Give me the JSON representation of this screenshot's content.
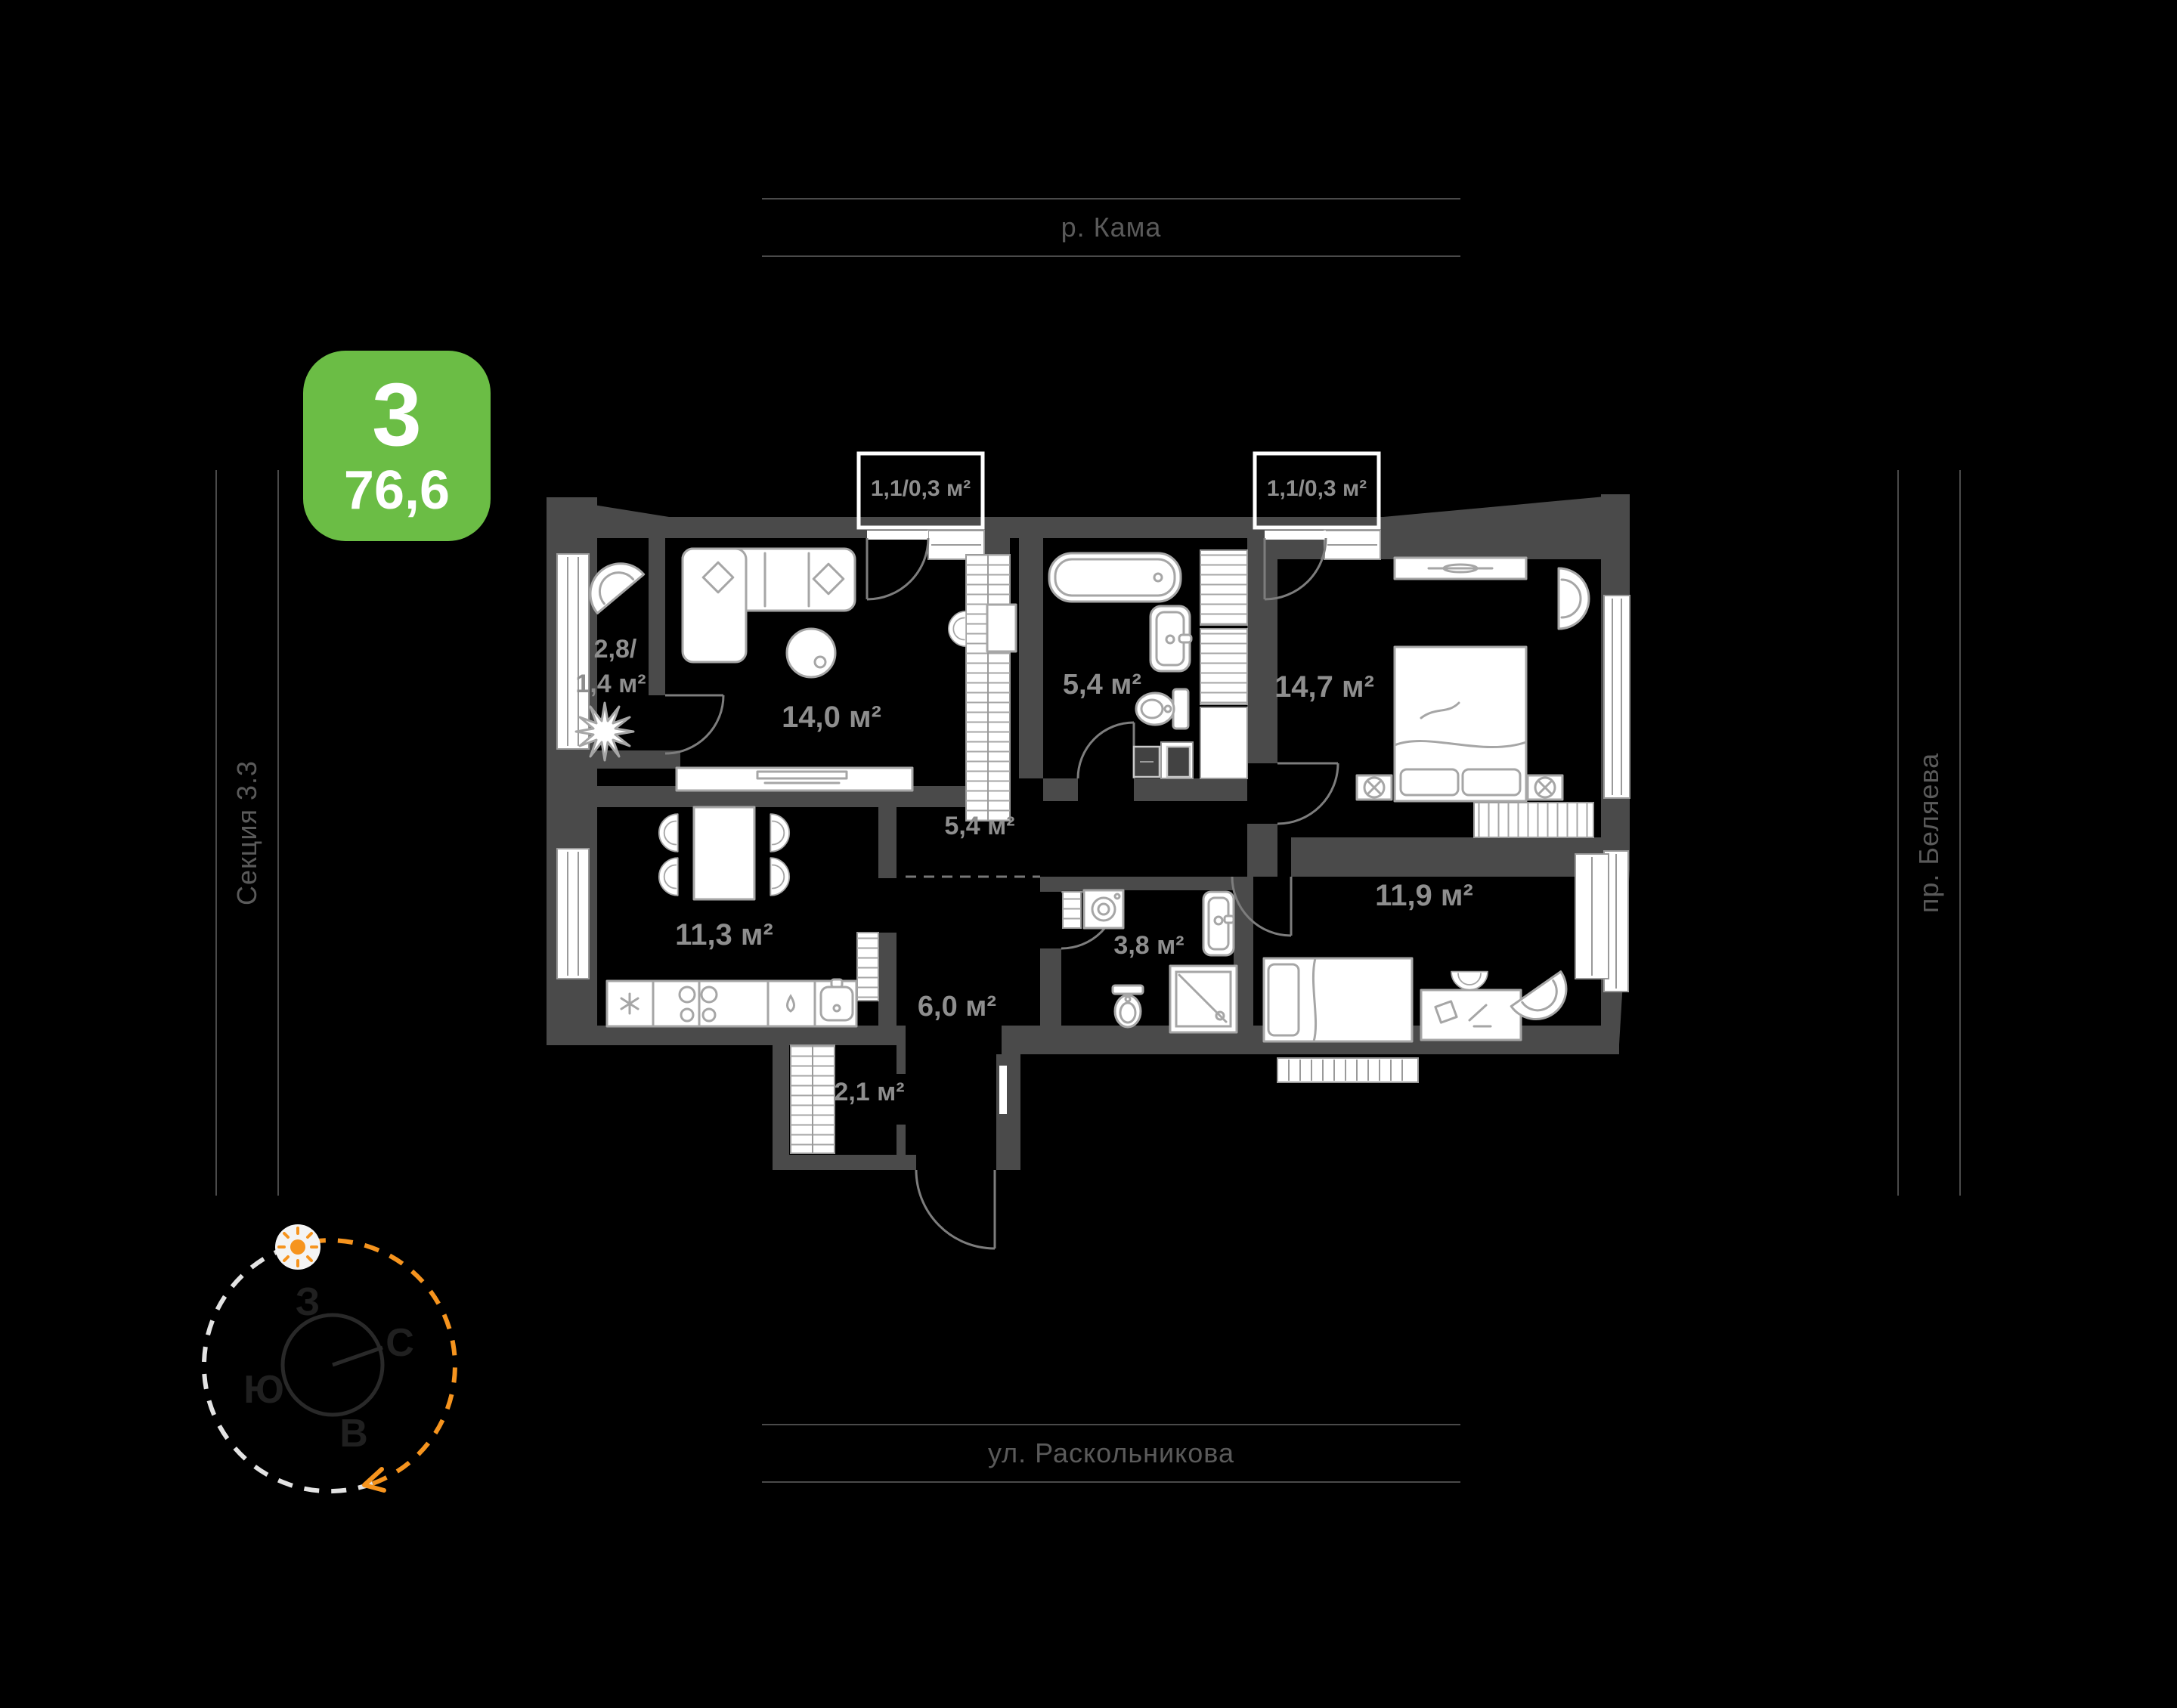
{
  "badge": {
    "number": "3",
    "area": "76,6"
  },
  "streets": {
    "top": "р. Кама",
    "bottom": "ул. Раскольникова",
    "left": "Секция 3.3",
    "right": "пр. Беляева"
  },
  "compass": {
    "west": "З",
    "north": "С",
    "south": "Ю",
    "east": "В"
  },
  "plan": {
    "rooms": [
      {
        "id": "loggia",
        "area_line1": "2,8/",
        "area_line2": "1,4 м²"
      },
      {
        "id": "living",
        "area": "14,0 м²"
      },
      {
        "id": "balcony-1",
        "area": "1,1/0,3 м²"
      },
      {
        "id": "bathroom",
        "area": "5,4 м²"
      },
      {
        "id": "balcony-2",
        "area": "1,1/0,3 м²"
      },
      {
        "id": "bedroom",
        "area": "14,7 м²"
      },
      {
        "id": "corridor",
        "area": "5,4 м²"
      },
      {
        "id": "kitchen",
        "area": "11,3 м²"
      },
      {
        "id": "hall",
        "area": "6,0 м²"
      },
      {
        "id": "bathroom-2",
        "area": "3,8 м²"
      },
      {
        "id": "bedroom-2",
        "area": "11,9 м²"
      },
      {
        "id": "wardrobe",
        "area": "2,1 м²"
      }
    ]
  },
  "colors": {
    "badge_green": "#6bbd45",
    "wall_gray": "#4a4a4a",
    "label_gray": "#8e8e8e",
    "street_gray": "#5a5a5a",
    "accent_orange": "#f6941e",
    "background": "#000000"
  }
}
